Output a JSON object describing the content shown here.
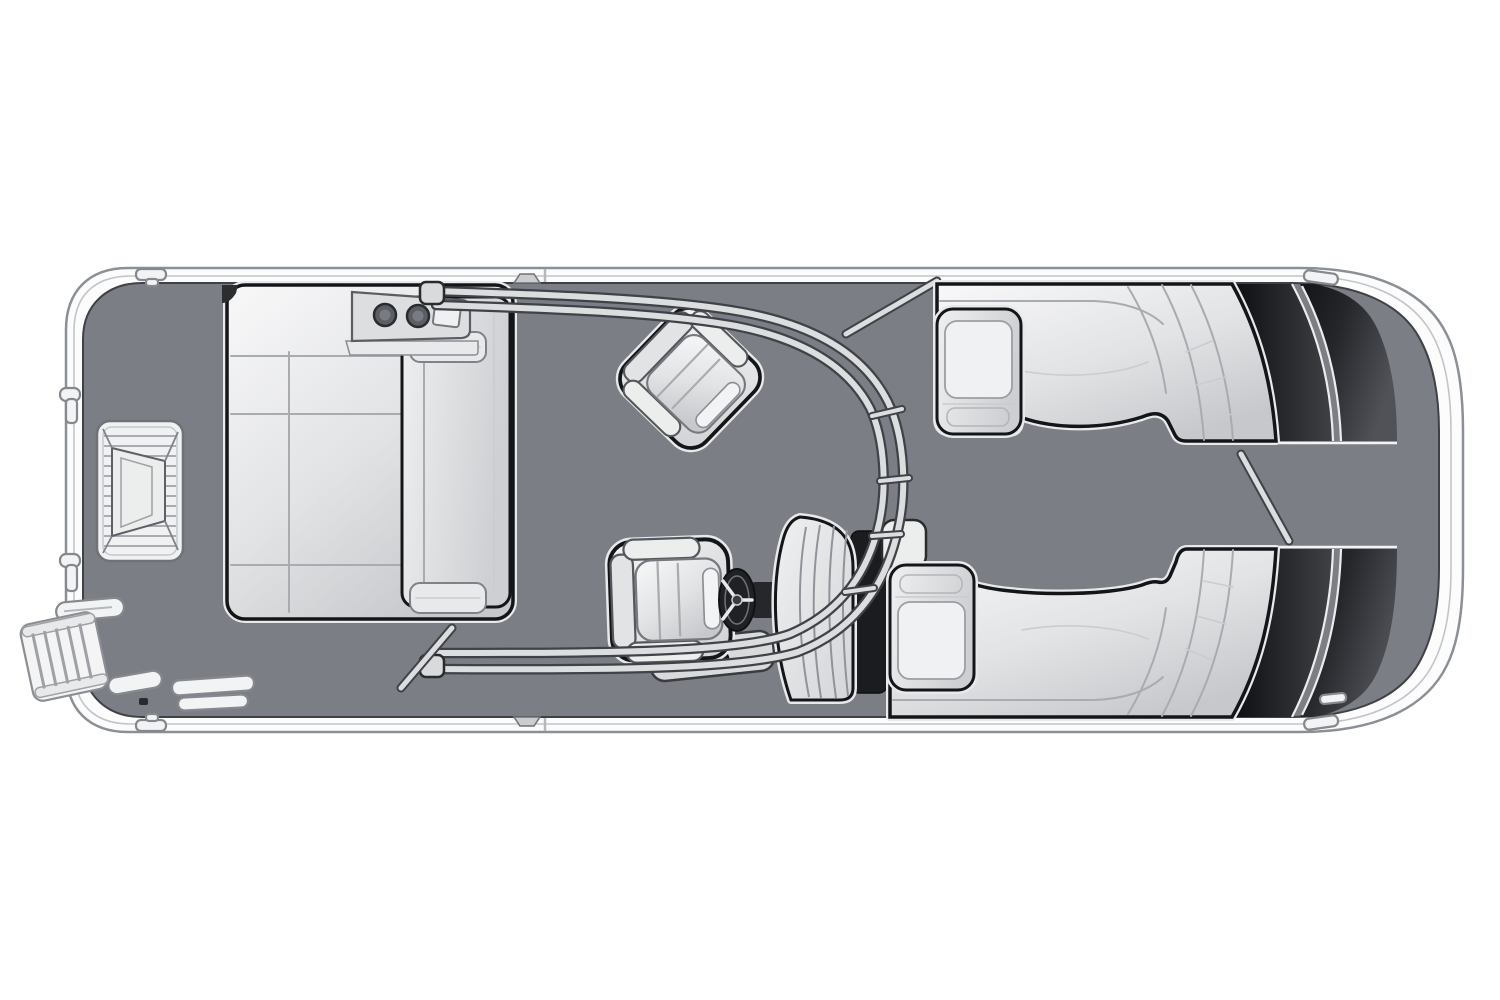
{
  "diagram": {
    "title": "Pontoon boat floor plan — overhead view",
    "canvas": {
      "width": 1500,
      "height": 1000
    },
    "colors": {
      "background": "#ffffff",
      "hull_band": "#fcfcfd",
      "hull_outline": "#8b9096",
      "hull_inner_line": "#c2c5c8",
      "deck": "#7b7e85",
      "deck_outline": "#3f4146",
      "seat_light": "#f8f8f9",
      "seat_mid": "#e2e3e5",
      "seat_shadow": "#c6c8cb",
      "seat_outline": "#141518",
      "seat_halo": "#e8e9ea",
      "seam": "#a8abaf",
      "bolster": "#e8e9ea",
      "console_fill": "#dcdee0",
      "cupholder": "#5b5e64",
      "cupholder_ring": "#2a2b2e",
      "dark_panel": "#0d0e10",
      "dark_panel_light": "#505258",
      "rail_dark": "#3f4247",
      "rail_light": "#dcdddf",
      "wheel": "#202125",
      "console_shadow": "#1b1c1f",
      "platform_fill": "#f0f1f2",
      "platform_stripe": "#a9acb0"
    },
    "components": [
      {
        "id": "hull",
        "label": "hull and rub rail"
      },
      {
        "id": "deck",
        "label": "main deck floor"
      },
      {
        "id": "stern-entry-steps",
        "label": "stern entry steps"
      },
      {
        "id": "boarding-ladder",
        "label": "stern boarding ladder"
      },
      {
        "id": "stern-grab-handles",
        "label": "stern grab handles and posts"
      },
      {
        "id": "port-stern-lounge",
        "label": "port stern chaise lounge"
      },
      {
        "id": "lounge-console",
        "label": "lounge corner console with two cupholders and tray"
      },
      {
        "id": "companion-swivel-chair",
        "label": "companion swivel chair"
      },
      {
        "id": "helm-chair",
        "label": "helm chair"
      },
      {
        "id": "helm-cupholder-base",
        "label": "helm cupholder base"
      },
      {
        "id": "steering-wheel",
        "label": "steering wheel"
      },
      {
        "id": "helm-console",
        "label": "helm console"
      },
      {
        "id": "console-shadow-panel",
        "label": "console shadow panel"
      },
      {
        "id": "sport-arch",
        "label": "sport arch with cross rungs"
      },
      {
        "id": "midship-gate-rail",
        "label": "midship gate rail"
      },
      {
        "id": "stern-gate-rail",
        "label": "stern gate rail"
      },
      {
        "id": "bow-gate-rail",
        "label": "bow gate rail"
      },
      {
        "id": "port-bow-lounge",
        "label": "port bow wraparound lounge"
      },
      {
        "id": "starboard-bow-lounge",
        "label": "starboard bow wraparound lounge"
      },
      {
        "id": "port-bow-armrest",
        "label": "port bow armrest"
      },
      {
        "id": "starboard-bow-armrest",
        "label": "starboard bow armrest"
      },
      {
        "id": "bow-panel-port",
        "label": "dark bow panel port side"
      },
      {
        "id": "bow-panel-starboard",
        "label": "dark bow panel starboard side"
      },
      {
        "id": "bow-walkway",
        "label": "bow walkway"
      },
      {
        "id": "deck-cleats",
        "label": "cleats and deck fittings"
      }
    ]
  }
}
